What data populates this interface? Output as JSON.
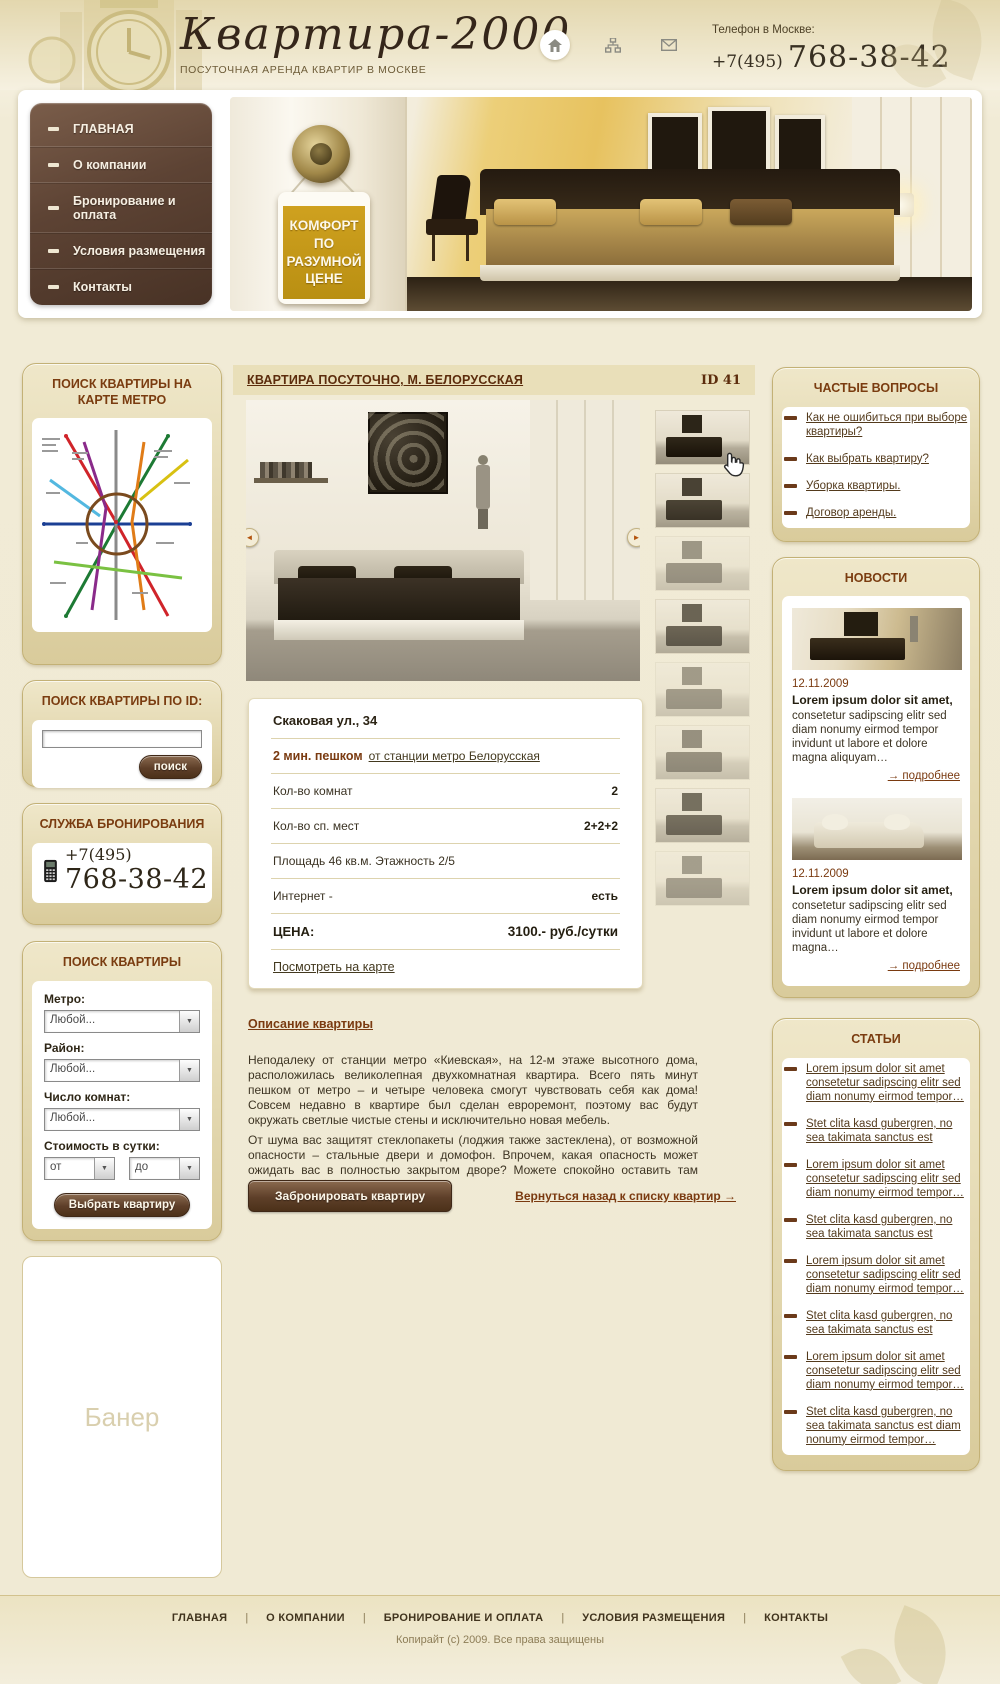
{
  "header": {
    "logo": "Квартира-2000",
    "tagline": "ПОСУТОЧНАЯ АРЕНДА КВАРТИР В МОСКВЕ",
    "phone_label": "Телефон в Москве:",
    "phone_prefix": "+7(495)",
    "phone_number": "768-38-42"
  },
  "menu": {
    "items": [
      "ГЛАВНАЯ",
      "О компании",
      "Бронирование и оплата",
      "Условия размещения",
      "Контакты"
    ]
  },
  "hero": {
    "tag": "КОМФОРТ ПО РАЗУМНОЙ ЦЕНЕ"
  },
  "sidebar": {
    "metro_search": {
      "title": "ПОИСК КВАРТИРЫ НА КАРТЕ МЕТРО"
    },
    "id_search": {
      "title": "ПОИСК КВАРТИРЫ ПО ID:",
      "button": "поиск",
      "input_value": ""
    },
    "booking": {
      "title": "СЛУЖБА БРОНИРОВАНИЯ",
      "phone_prefix": "+7(495)",
      "phone_number": "768-38-42"
    },
    "search_form": {
      "title": "ПОИСК КВАРТИРЫ",
      "metro_label": "Метро:",
      "metro_value": "Любой...",
      "district_label": "Район:",
      "district_value": "Любой...",
      "rooms_label": "Число комнат:",
      "rooms_value": "Любой...",
      "price_label": "Стоимость в сутки:",
      "price_from": "от",
      "price_to": "до",
      "submit": "Выбрать квартиру"
    },
    "banner": {
      "label": "Банер"
    }
  },
  "content": {
    "title": "КВАРТИРА ПОСУТОЧНО, М. БЕЛОРУССКАЯ",
    "id_label": "ID 41",
    "details": {
      "address": "Скаковая ул., 34",
      "walk_time": "2 мин. пешком",
      "walk_link": "от станции метро Белорусская",
      "rooms_label": "Кол-во комнат",
      "rooms_value": "2",
      "beds_label": "Кол-во сп. мест",
      "beds_value": "2+2+2",
      "area_floor": "Площадь 46 кв.м. Этажность 2/5",
      "internet_label": "Интернет  -",
      "internet_value": "есть",
      "price_label": "ЦЕНА:",
      "price_value": "3100.- руб./сутки",
      "map_link": "Посмотреть на карте"
    },
    "description": {
      "heading": "Описание квартиры",
      "p1": "Неподалеку от станции метро «Киевская», на 12-м этаже высотного дома, расположилась великолепная двухкомнатная квартира. Всего пять минут пешком от метро – и четыре человека смогут чувствовать себя как дома! Совсем недавно в квартире был сделан евроремонт, поэтому вас будут окружать светлые чистые стены и исключительно новая мебель.",
      "p2": "От шума вас защитят стеклопакеты (лоджия также застеклена), от возможной опасности – стальные двери и домофон. Впрочем, какая опасность может ожидать вас в полностью закрытом дворе? Можете спокойно оставить там даже автомобиль."
    },
    "book_button": "Забронировать квартиру",
    "back_link": "Вернуться назад к списку квартир →"
  },
  "faq": {
    "title": "ЧАСТЫЕ ВОПРОСЫ",
    "items": [
      "Как не ошибиться при выборе квартиры?",
      "Как выбрать квартиру?",
      "Уборка квартиры.",
      "Договор аренды."
    ]
  },
  "news": {
    "title": "НОВОСТИ",
    "items": [
      {
        "date": "12.11.2009",
        "title": "Lorem ipsum dolor sit amet,",
        "text": "consetetur sadipscing elitr sed diam nonumy eirmod tempor invidunt ut labore et dolore magna aliquyam…",
        "more": "→ подробнее"
      },
      {
        "date": "12.11.2009",
        "title": "Lorem ipsum dolor sit amet,",
        "text": "consetetur sadipscing elitr sed diam nonumy eirmod tempor invidunt ut labore et dolore magna…",
        "more": "→ подробнее"
      }
    ]
  },
  "articles": {
    "title": "СТАТЬИ",
    "items": [
      "Lorem ipsum dolor sit amet consetetur sadipscing elitr sed diam nonumy eirmod tempor…",
      "Stet clita kasd gubergren, no sea takimata sanctus est",
      "Lorem ipsum dolor sit amet consetetur sadipscing elitr sed diam nonumy eirmod tempor…",
      "Stet clita kasd gubergren, no sea takimata sanctus est",
      "Lorem ipsum dolor sit amet consetetur sadipscing elitr sed diam nonumy eirmod tempor…",
      "Stet clita kasd gubergren, no sea takimata sanctus est",
      "Lorem ipsum dolor sit amet consetetur sadipscing elitr sed diam nonumy eirmod tempor…",
      "Stet clita kasd gubergren, no sea takimata sanctus est diam nonumy eirmod tempor…"
    ]
  },
  "footer": {
    "links": [
      "ГЛАВНАЯ",
      "О КОМПАНИИ",
      "БРОНИРОВАНИЕ И ОПЛАТА",
      "УСЛОВИЯ РАЗМЕЩЕНИЯ",
      "КОНТАКТЫ"
    ],
    "separator": "|",
    "copyright": "Копирайт (с) 2009. Все права защищены"
  },
  "glyphs": {
    "prev": "◄",
    "next": "►",
    "select_arrow": "▼"
  },
  "colors": {
    "accent_brown": "#7a3c10",
    "menu_brown": "#5d4334",
    "gold_tag": "#c59a1c",
    "panel_beige": "#e9dfb9",
    "page_bg": "#f1ebd6"
  }
}
